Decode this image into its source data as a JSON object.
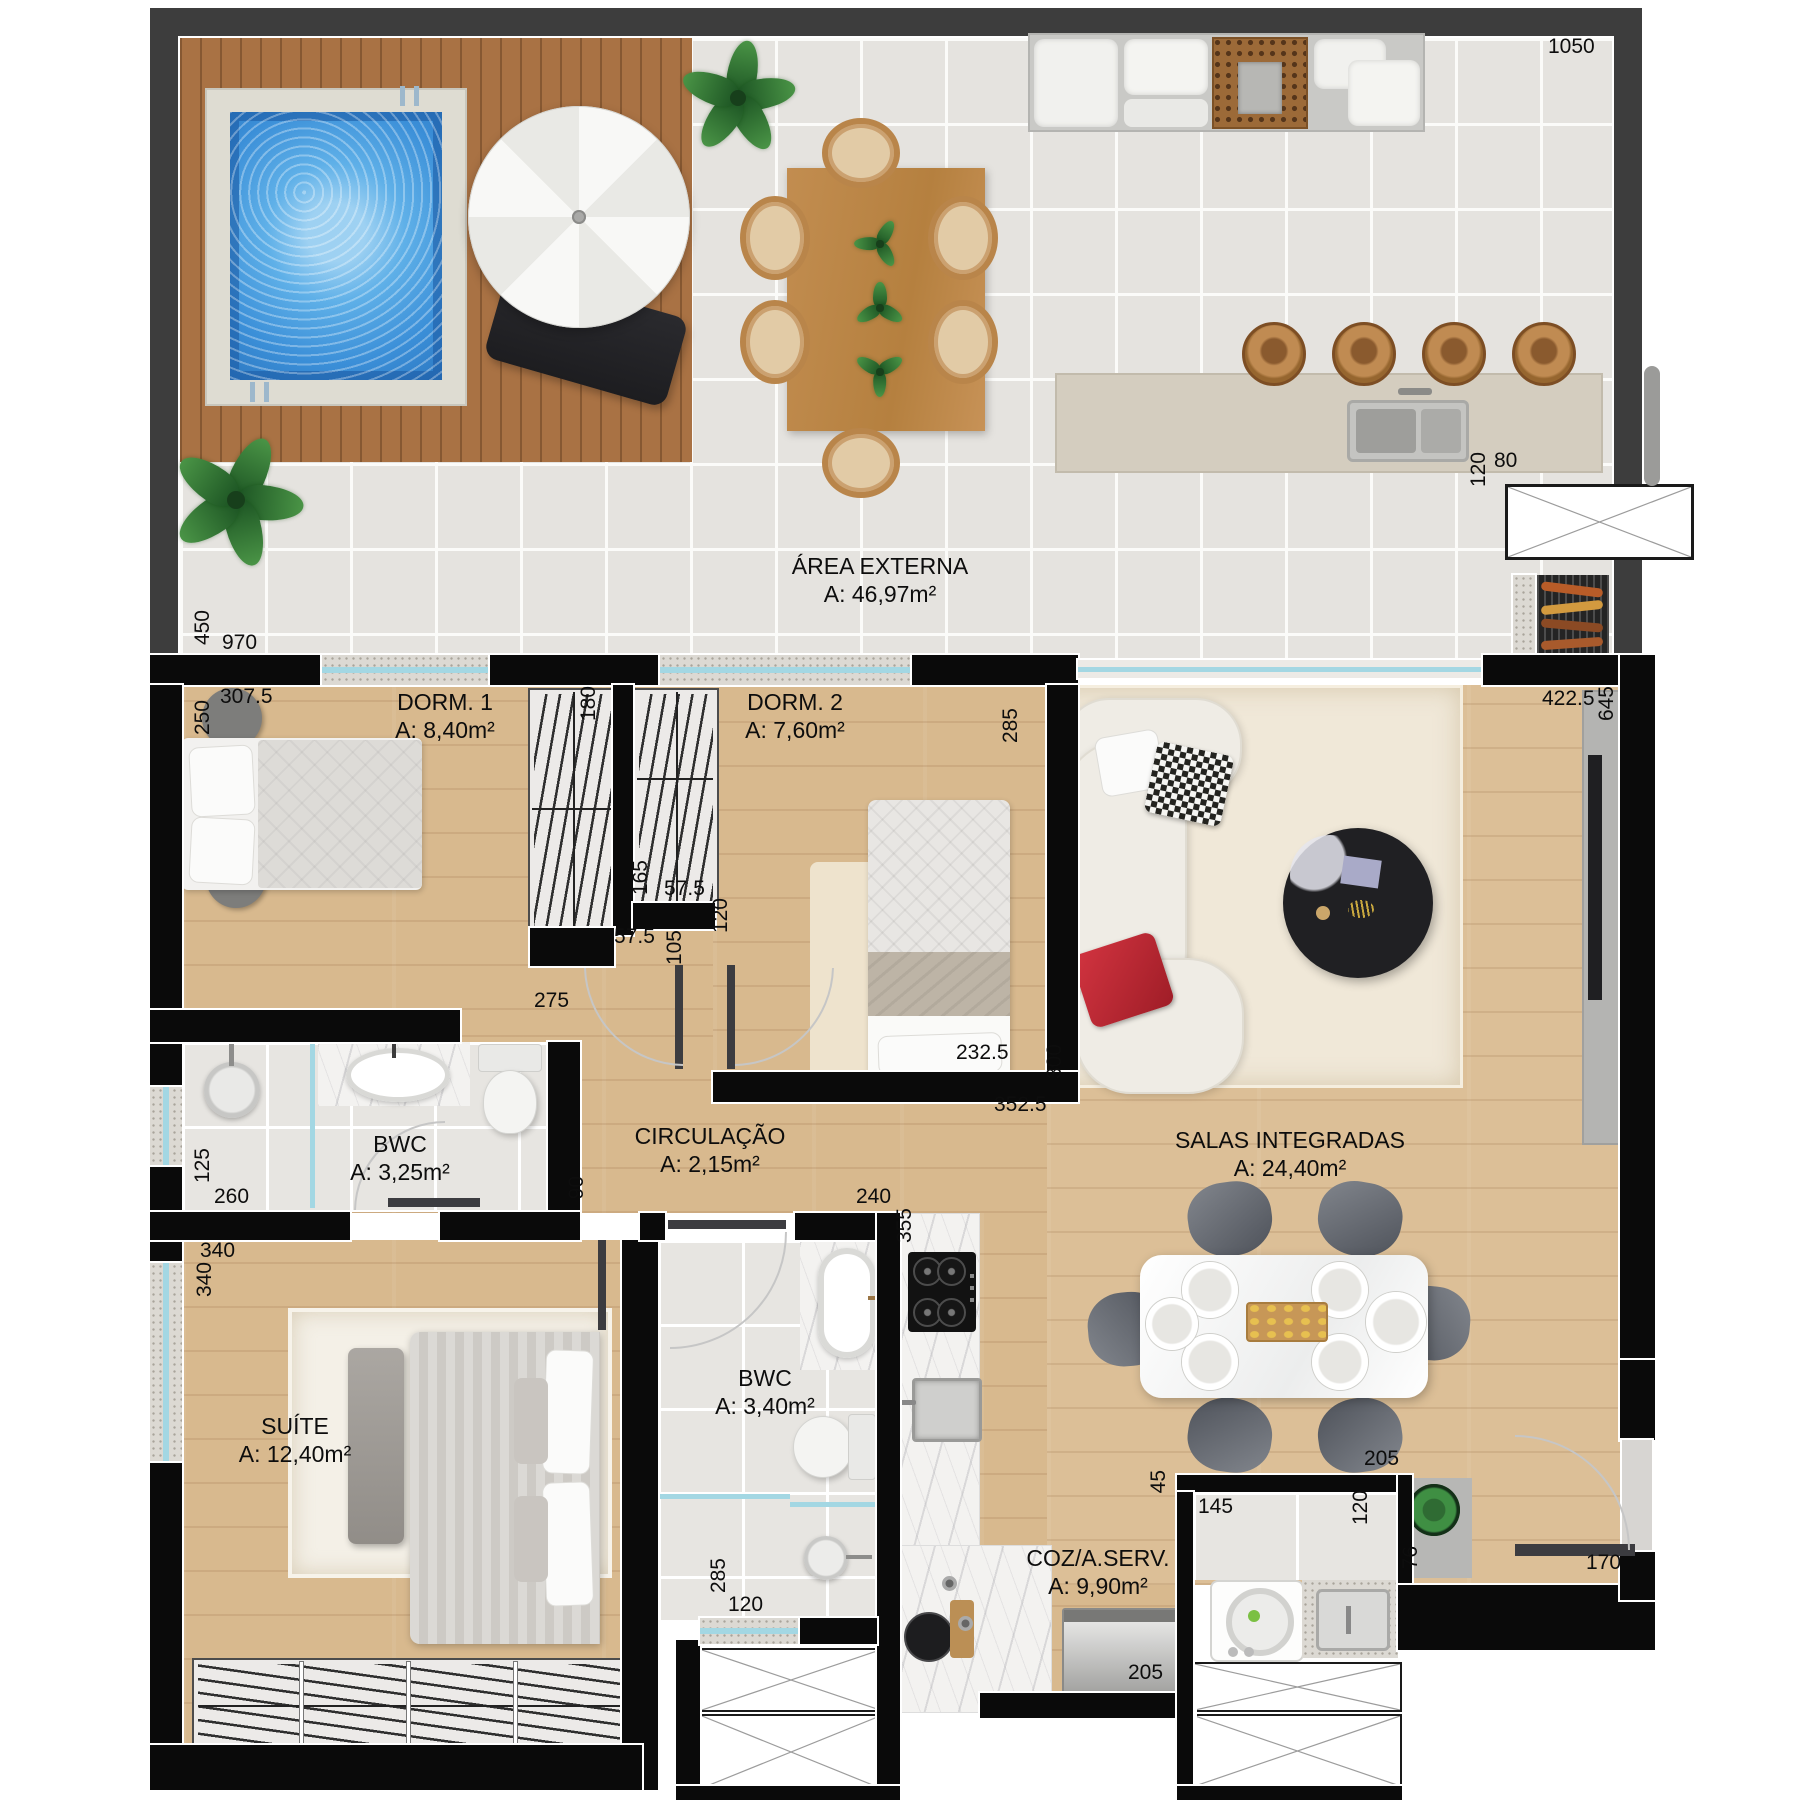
{
  "plan": {
    "rooms": [
      {
        "name": "ÁREA EXTERNA",
        "area": "A: 46,97m²"
      },
      {
        "name": "DORM. 1",
        "area": "A: 8,40m²"
      },
      {
        "name": "DORM. 2",
        "area": "A: 7,60m²"
      },
      {
        "name": "BWC",
        "area": "A: 3,25m²"
      },
      {
        "name": "CIRCULAÇÃO",
        "area": "A: 2,15m²"
      },
      {
        "name": "SALAS INTEGRADAS",
        "area": "A: 24,40m²"
      },
      {
        "name": "SUÍTE",
        "area": "A: 12,40m²"
      },
      {
        "name": "BWC",
        "area": "A: 3,40m²"
      },
      {
        "name": "COZ/A.SERV.",
        "area": "A: 9,90m²"
      }
    ],
    "dims": {
      "terrace_top": "1050",
      "shaft_w": "80",
      "shaft_h": "120",
      "terrace_left": "450",
      "terrace_bottom": "970",
      "dorm1_w": "307.5",
      "dorm1_bed": "250",
      "closet1": "180",
      "dorm2_h": "285",
      "closet2": "165",
      "gap_a": "57.5",
      "gap_b": "57.5",
      "door1": "105",
      "door2": "120",
      "dorm1_bottom": "275",
      "dorm2_bottom": "232.5",
      "living_wall": "300",
      "living_off": "352.5",
      "living_w": "422.5",
      "living_h": "645",
      "bwc1_h": "125",
      "bwc1_w": "260",
      "hall_door": "90",
      "suite_w": "340",
      "suite_win": "340",
      "bwc2_top": "240",
      "kitchen_len": "355",
      "bwc2_h": "285",
      "bwc2_door": "120",
      "dining": "205",
      "laundry_gap": "45",
      "laundry_w": "145",
      "laundry_h": "120",
      "shelf_h": "76",
      "coz_bottom": "205",
      "entry_w": "170"
    },
    "colors": {
      "wall": "#0a0a0a",
      "terrace_frame": "#3d3d3d",
      "pool_water": "#3c92dc",
      "wood_floor": "#d8b98e",
      "window_glass": "#a3d7e3",
      "accent_red_pillow": "#c22833",
      "plant_green": "#2f6b33"
    }
  }
}
